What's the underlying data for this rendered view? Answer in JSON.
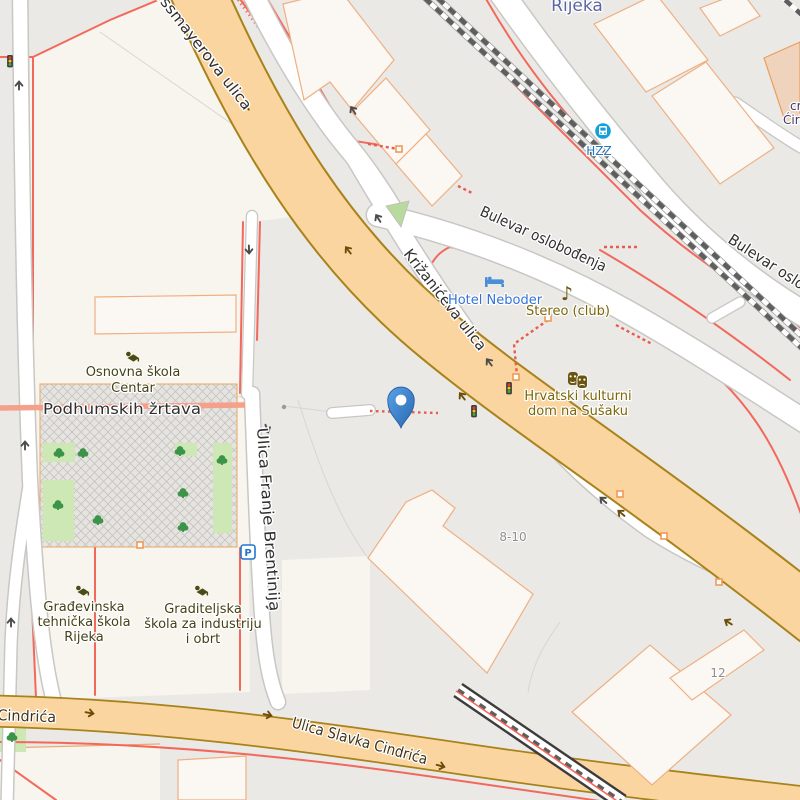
{
  "map": {
    "city_label": "Rijeka",
    "streets": {
      "strossmayerova": "Strossmayerova ulica",
      "krizaniceva": "Križanićeva ulica",
      "bulevar": "Bulevar oslobođenja",
      "bulevar2": "Bulevar oslobođenja",
      "brentinija": "Ulica Franje Brentinija",
      "podhumskih": "Podhumskih žrtava",
      "cindrica": "Ulica Slavka Cindrića",
      "cindrica_left": "Ulica Slavka Cindrića"
    },
    "pois": {
      "school_centar": {
        "line1": "Osnovna škola",
        "line2": "Centar"
      },
      "hotel": "Hotel Neboder",
      "club": "Stereo (club)",
      "kulturni_dom": {
        "line1": "Hrvatski kulturni",
        "line2": "dom na Sušaku"
      },
      "school_gradjevinska": {
        "line1": "Građevinska",
        "line2": "tehnička škola",
        "line3": "Rijeka"
      },
      "school_graditeljska": {
        "line1": "Graditeljska",
        "line2": "škola za industriju",
        "line3": "i obrt"
      },
      "bus_stop": "HZZ",
      "church": {
        "line1": "cr",
        "line2": "Ćiri"
      },
      "parking": "P"
    },
    "housenumbers": {
      "a": "8-10",
      "b": "12"
    },
    "marker": {
      "type": "map-pin",
      "color": "#3d7fd0"
    },
    "colors": {
      "land": "#eae9e6",
      "block_cream": "#f8f5ef",
      "building_fill": "#fbf7f2",
      "building_stroke": "#eeb083",
      "road_orange_fill": "#fbd59f",
      "road_orange_casing": "#a8821a",
      "road_white": "#ffffff",
      "road_casing": "#c9c7c4",
      "salmon_line": "#f2695c",
      "living_street": "#f4a08b",
      "railway": "#5e5e5e",
      "park_green": "#cde8b4",
      "tree_green": "#3b9447",
      "pin_blue": "#3d7fd0",
      "hzz_blue": "#12a0dc"
    }
  }
}
